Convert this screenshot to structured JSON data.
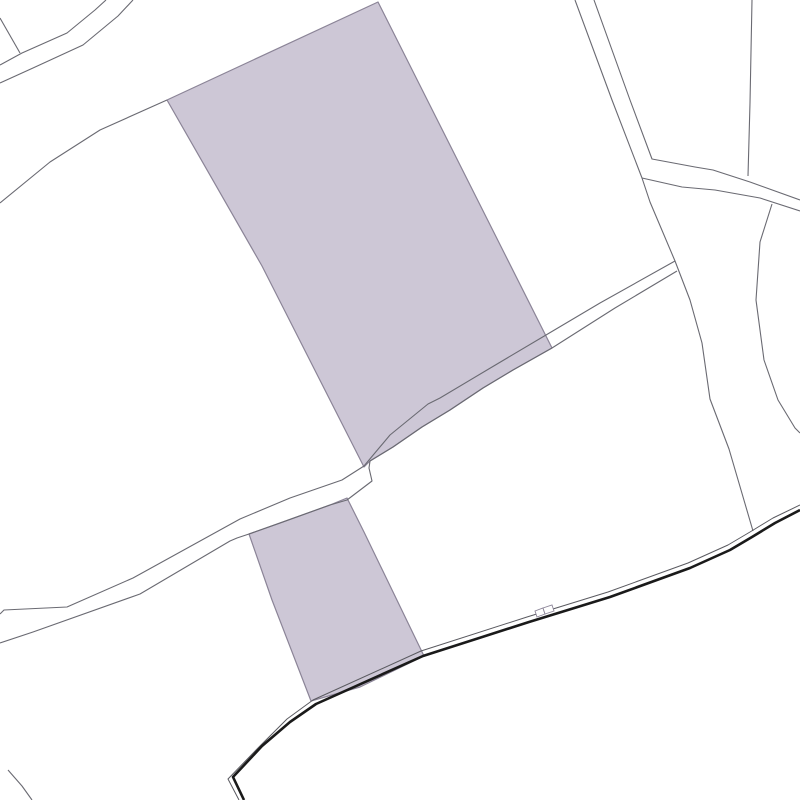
{
  "map": {
    "kind": "cadastral-parcel-map",
    "canvas": {
      "width": 800,
      "height": 800,
      "background": "#ffffff"
    },
    "colors": {
      "parcel_fill": "#cdc7d6",
      "parcel_stroke": "#8b8497",
      "boundary_line": "#6a6a72",
      "road_casing_thick": "#1a1a1a",
      "road_casing_thin": "#5a5a60",
      "marker_fill": "#ffffff",
      "marker_stroke": "#8b8497"
    },
    "parcels": [
      {
        "name": "highlighted-parcel-large",
        "points": "378,2 552,348 513,370 483,388 450,410 422,427 393,447 370,461 364,467 262,266 167,100"
      },
      {
        "name": "highlighted-parcel-small",
        "points": "347,498 364,532 424,656 360,687 311,701 272,600 249,534 280,523 330,505"
      }
    ],
    "lines": [
      {
        "name": "road-nw-upper-edge",
        "role": "boundary",
        "points": "106,0 95,10 67,33 22,53 0,65"
      },
      {
        "name": "road-nw-lower-edge",
        "role": "boundary",
        "points": "133,0 118,16 83,45 33,68 0,83"
      },
      {
        "name": "spur-top-left",
        "role": "boundary",
        "points": "0,18 20,53"
      },
      {
        "name": "boundary-west",
        "role": "boundary",
        "points": "0,203 50,162 100,130 167,100"
      },
      {
        "name": "boundary-long-north-south",
        "role": "boundary",
        "points": "575,0 612,100 642,178 650,202 675,261 690,300 702,343 710,399 729,449 741,490 753,531"
      },
      {
        "name": "road-ne-upper-edge",
        "role": "boundary",
        "points": "594,0 630,100 652,159 695,167 713,170 750,182 800,200"
      },
      {
        "name": "road-ne-lower-edge",
        "role": "boundary",
        "points": "642,178 682,187 715,190 760,198 800,211"
      },
      {
        "name": "boundary-top-right",
        "role": "boundary",
        "points": "752,0 750,103 748,176"
      },
      {
        "name": "boundary-east",
        "role": "boundary",
        "points": "772,204 760,242 756,300 764,360 778,400 795,428 800,433"
      },
      {
        "name": "lane-upper-edge",
        "role": "boundary",
        "points": "675,261 600,303 546,335 487,370 440,398 428,404 390,435 364,466 342,480 290,498 240,519 133,578 67,607 4,610 0,614"
      },
      {
        "name": "lane-lower-edge",
        "role": "boundary",
        "points": "677,271 615,308 552,348 513,370 483,388 450,410 422,427 393,447 370,461 369,468 372,481 347,500 330,505 280,523 249,534 237,538 230,541 140,594 33,632 0,643"
      },
      {
        "name": "boundary-bottom-left",
        "role": "boundary",
        "points": "8,770 22,786 32,800"
      },
      {
        "name": "track-south-thin-edge",
        "role": "road-thin",
        "points": "239,800 228,779 258,748 287,719 313,700 421,651 527,617 608,592 688,563 728,545 750,532 773,518 800,505"
      },
      {
        "name": "track-south-thick-edge",
        "role": "road-thick",
        "points": "244,800 233,777 262,746 290,722 316,704 423,656 529,622 610,597 690,568 730,550 752,537 775,523 800,510"
      }
    ],
    "markers": [
      {
        "name": "small-building-marker-1",
        "points": "537,617 545,614 543,608 535,611"
      },
      {
        "name": "small-building-marker-2",
        "points": "545,614 554,611 552,605 543,608"
      }
    ]
  }
}
